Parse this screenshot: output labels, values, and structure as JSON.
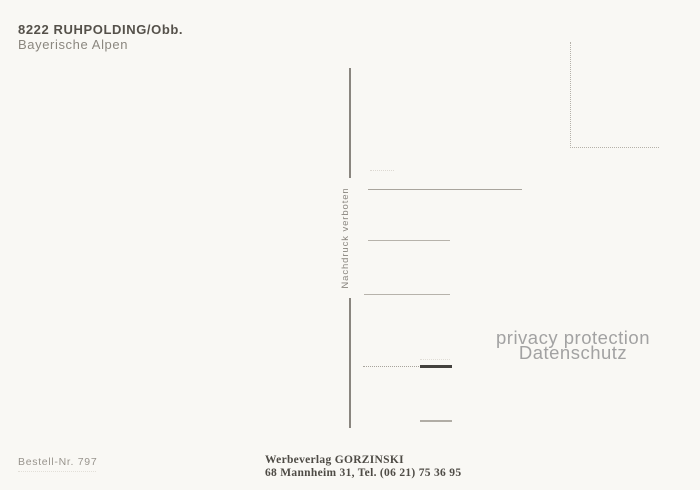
{
  "header": {
    "postal_title": "8222 RUHPOLDING/Obb.",
    "subtitle": "Bayerische Alpen"
  },
  "center_divider": {
    "notice": "Nachdruck verboten"
  },
  "watermark": {
    "line1": "privacy protection",
    "line2": "Datenschutz"
  },
  "footer": {
    "order_number": "Bestell-Nr. 797",
    "publisher_name": "Werbeverlag GORZINSKI",
    "publisher_address": "68 Mannheim 31, Tel. (06 21) 75 36 95"
  },
  "colors": {
    "paper": "#f9f8f4",
    "ink_dark": "#55514a",
    "ink_gray": "#8b877f",
    "line_gray": "#b3afa7",
    "dark_bar": "#44423e",
    "watermark_gray": "#a2a2a2"
  }
}
